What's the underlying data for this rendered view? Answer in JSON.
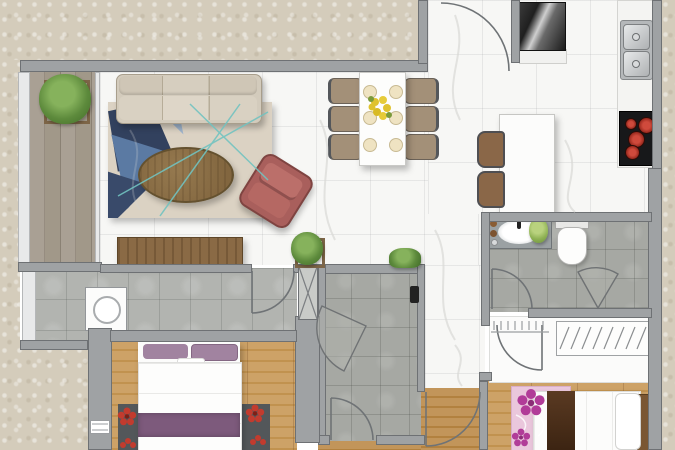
{
  "palette": {
    "exterior_ground": "#d4ccbb",
    "wall": "#9fa2a4",
    "marble_floor": "#f7f7f5",
    "grey_tile": "#b2b4b0",
    "wood_floor": "#c99f66",
    "balcony_wood": "#a39a8d",
    "sofa_beige": "#d3cbbc",
    "armchair_rose": "#b06762",
    "table_wood": "#8a6f4b",
    "rug_navy": "#33425f",
    "rug_teal_line": "#72c3c0",
    "cooktop_black": "#17181a",
    "burner_red": "#c0392b",
    "bed_purple": "#7d5a7c",
    "rug_pink": "#eac7dc",
    "plant_green": "#5d8a3c",
    "stainless": "#c9ccce"
  },
  "floor_plan": {
    "title": "Apartment floor plan (top view)",
    "rooms": [
      {
        "id": "balcony",
        "name": "Balcony",
        "floor": "wood planks"
      },
      {
        "id": "living-room",
        "name": "Living room",
        "floor": "marble tile"
      },
      {
        "id": "dining-area",
        "name": "Dining area",
        "floor": "marble tile"
      },
      {
        "id": "kitchen-entry",
        "name": "Kitchen and entry",
        "floor": "marble tile"
      },
      {
        "id": "hallway",
        "name": "Hallway",
        "floor": "grey tile"
      },
      {
        "id": "utility-room",
        "name": "Utility / shower room",
        "floor": "grey tile"
      },
      {
        "id": "bathroom",
        "name": "Bathroom",
        "floor": "grey tile"
      },
      {
        "id": "bedroom-1",
        "name": "Bedroom 1",
        "floor": "wood"
      },
      {
        "id": "bedroom-2",
        "name": "Bedroom 2",
        "floor": "wood"
      },
      {
        "id": "corridor",
        "name": "Corridor",
        "floor": "wood"
      },
      {
        "id": "dressing-area",
        "name": "Dressing area",
        "floor": "white"
      }
    ],
    "furniture": [
      {
        "id": "sofa",
        "name": "Three-seat sofa"
      },
      {
        "id": "area-rug",
        "name": "Geometric area rug"
      },
      {
        "id": "coffee-table",
        "name": "Oval wood coffee table"
      },
      {
        "id": "armchair",
        "name": "Rose armchair"
      },
      {
        "id": "tv-console",
        "name": "TV console"
      },
      {
        "id": "dining-table",
        "name": "Dining table for six"
      },
      {
        "id": "dining-chair",
        "name": "Dining chair"
      },
      {
        "id": "kitchen-island",
        "name": "Kitchen island counter"
      },
      {
        "id": "bar-stool",
        "name": "Bar stool"
      },
      {
        "id": "mirror-cabinet",
        "name": "Mirrored entry cabinet"
      },
      {
        "id": "kitchen-counter",
        "name": "Kitchen counter"
      },
      {
        "id": "double-sink",
        "name": "Double-bowl kitchen sink"
      },
      {
        "id": "cooktop",
        "name": "Four-burner cooktop"
      },
      {
        "id": "vanity",
        "name": "Vanity counter with basin"
      },
      {
        "id": "toilet",
        "name": "Toilet"
      },
      {
        "id": "shower-door",
        "name": "Folding shower door"
      },
      {
        "id": "wardrobe",
        "name": "Built-in wardrobe with hangers"
      },
      {
        "id": "washing-machine",
        "name": "Washing machine"
      },
      {
        "id": "bed-1",
        "name": "Double bed with purple runner"
      },
      {
        "id": "bed-1-rug",
        "name": "Dark flower rug"
      },
      {
        "id": "bed-2",
        "name": "Double bed with brown runner"
      },
      {
        "id": "bed-2-rug",
        "name": "Pink floral rug"
      },
      {
        "id": "potted-plant",
        "name": "Potted plant"
      },
      {
        "id": "window",
        "name": "Window"
      }
    ]
  }
}
